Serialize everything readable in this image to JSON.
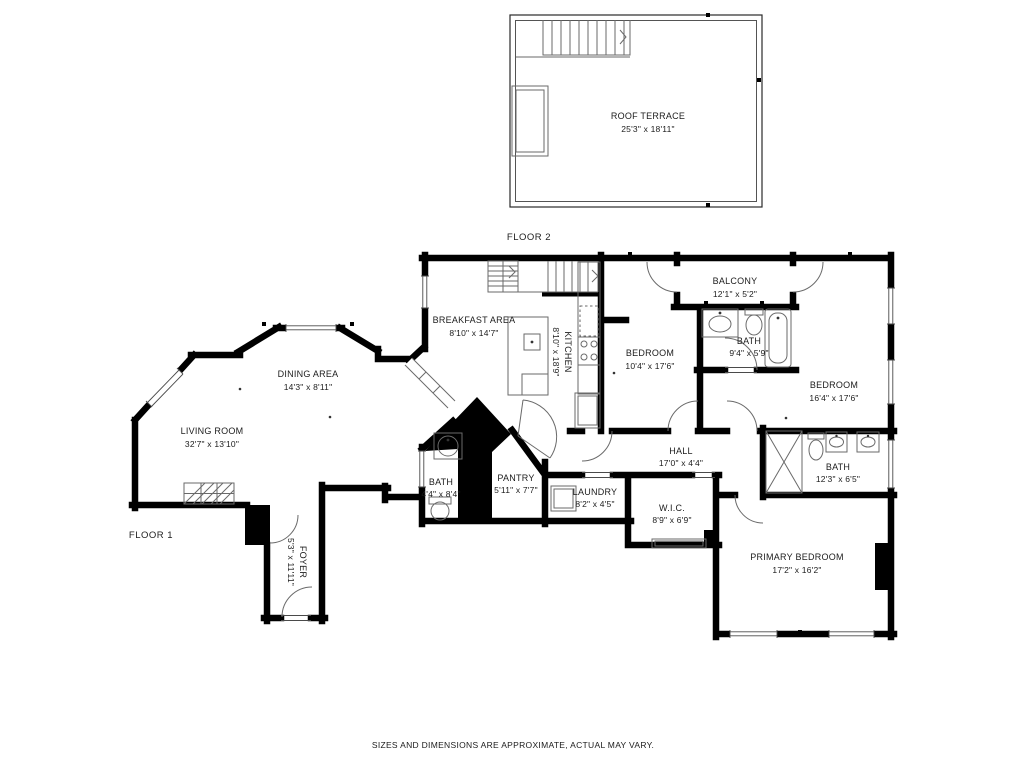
{
  "floors": {
    "floor2": {
      "label": "FLOOR 2"
    },
    "floor1": {
      "label": "FLOOR 1"
    }
  },
  "rooms": {
    "roof_terrace": {
      "name": "ROOF TERRACE",
      "dims": "25'3\" x 18'11\""
    },
    "breakfast_area": {
      "name": "BREAKFAST AREA",
      "dims": "8'10\" x 14'7\""
    },
    "kitchen": {
      "name": "KITCHEN",
      "dims": "8'10\" x 18'9\""
    },
    "dining_area": {
      "name": "DINING AREA",
      "dims": "14'3\" x 8'11\""
    },
    "living_room": {
      "name": "LIVING ROOM",
      "dims": "32'7\" x 13'10\""
    },
    "bath_main": {
      "name": "BATH",
      "dims": "4'4\" x 8'4\""
    },
    "pantry": {
      "name": "PANTRY",
      "dims": "5'11\" x 7'7\""
    },
    "laundry": {
      "name": "LAUNDRY",
      "dims": "8'2\" x 4'5\""
    },
    "hall": {
      "name": "HALL",
      "dims": "17'0\" x 4'4\""
    },
    "wic": {
      "name": "W.I.C.",
      "dims": "8'9\" x 6'9\""
    },
    "foyer": {
      "name": "FOYER",
      "dims": "5'3\" x 11'11\""
    },
    "bedroom_1": {
      "name": "BEDROOM",
      "dims": "10'4\" x 17'6\""
    },
    "balcony": {
      "name": "BALCONY",
      "dims": "12'1\" x 5'2\""
    },
    "bath_upper": {
      "name": "BATH",
      "dims": "9'4\" x 5'9\""
    },
    "bedroom_2": {
      "name": "BEDROOM",
      "dims": "16'4\" x 17'6\""
    },
    "bath_primary": {
      "name": "BATH",
      "dims": "12'3\" x 6'5\""
    },
    "primary_bedroom": {
      "name": "PRIMARY BEDROOM",
      "dims": "17'2\" x 16'2\""
    }
  },
  "disclaimer": "SIZES AND DIMENSIONS ARE APPROXIMATE, ACTUAL MAY VARY.",
  "colors": {
    "wall": "#000000",
    "fixture": "#6a6a6a",
    "background": "#ffffff",
    "text": "#1c1c1c"
  }
}
